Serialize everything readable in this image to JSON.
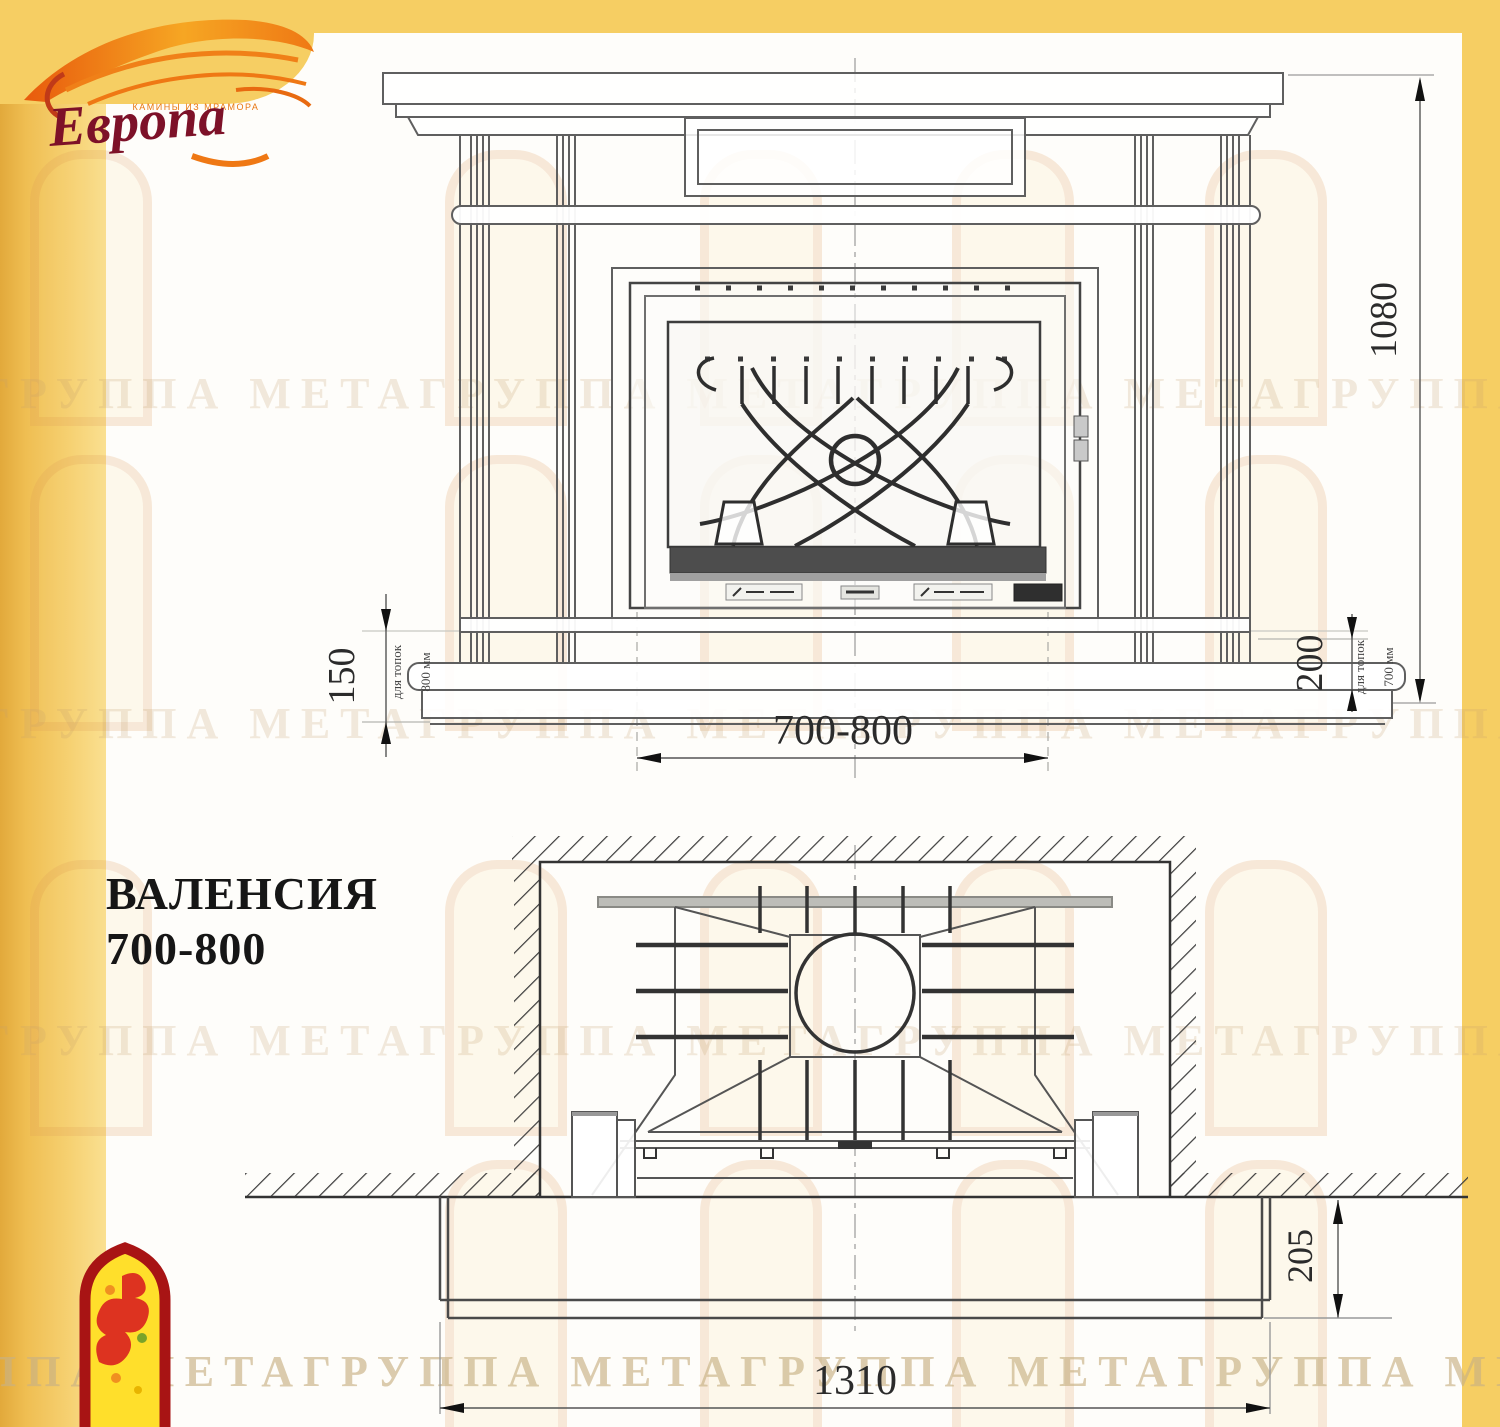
{
  "brand": {
    "name": "Европа",
    "tagline": "КАМИНЫ ИЗ МРАМОРА"
  },
  "title": {
    "line1": "ВАЛЕНСИЯ",
    "line2": "700-800"
  },
  "watermark": {
    "rows": [
      "ГРУППА МЕТАГРУППА МЕТАГРУППА МЕТАГРУППА МЕТ",
      "ГРУППА МЕТАГРУППА МЕТАГРУППА МЕТАГРУППА МЕТА",
      "ГРУППА МЕТАГРУППА МЕТАГРУППА МЕТАГРУППА МЕТА",
      "ППА МЕТАГРУППА МЕТАГРУППА МЕТАГРУППА МЕТА"
    ]
  },
  "front_view": {
    "dim_height": "1080",
    "dim_left": "150",
    "dim_left_note1": "для топок",
    "dim_left_note2": "800 мм",
    "dim_right": "200",
    "dim_right_note1": "для топок",
    "dim_right_note2": "700 мм",
    "dim_width": "700-800"
  },
  "plan_view": {
    "dim_depth": "205",
    "dim_width": "1310"
  },
  "colors": {
    "frame_yellow": "#F6CE63",
    "frame_gold": "#E9B94E",
    "logo_red": "#7D1128",
    "logo_orange": "#EF7814",
    "arch_logo_red": "#A81414",
    "arch_logo_yellow": "#FFDF2B",
    "line_gray": "#5F5F5F"
  }
}
